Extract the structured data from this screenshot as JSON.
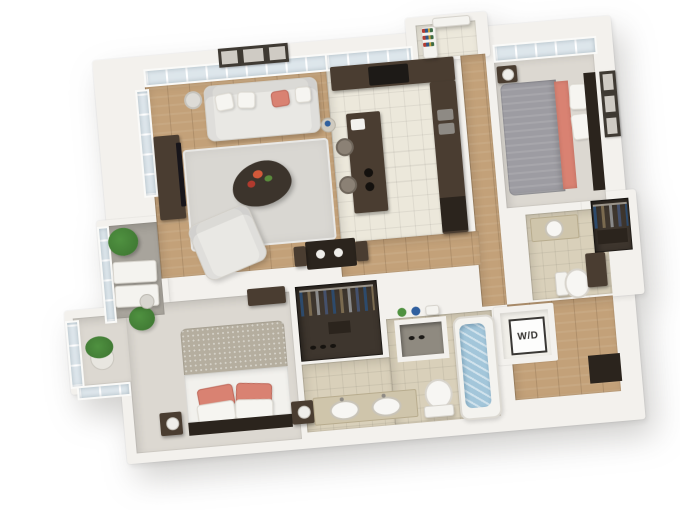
{
  "labels": {
    "washer_dryer": "W/D"
  },
  "palette": {
    "background": "#ffffff",
    "wall": "#f3f1ed",
    "wood": "#c3a179",
    "carpet": "#dcd8d1",
    "tile_kitchen": "#ece8db",
    "tile_bath": "#d9d0ba",
    "cabinet": "#4a3d31",
    "cabinet_dark": "#2b241d",
    "sofa": "#e9e8e4",
    "coral": "#d98272",
    "bed_gray": "#9d9ca2",
    "blanket": "#b5ae9f",
    "duvet": "#f2f1ed",
    "water": "#a3c6da",
    "plant": "#4f9140",
    "plant_dark": "#3c7330",
    "rug": "#d9d7d2",
    "balcony_floor": "#a8a49c",
    "glass": "#dde6eb",
    "frame_dark": "#3f3a33",
    "closet_interior": "#3e362e",
    "metal": "#8e8a84"
  }
}
